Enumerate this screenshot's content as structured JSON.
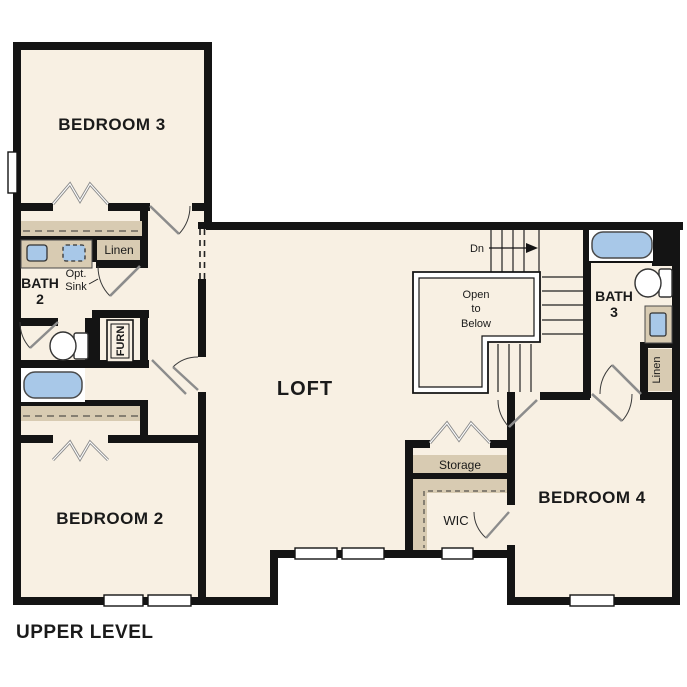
{
  "title": "UPPER LEVEL",
  "palette": {
    "wall": "#141414",
    "floor": "#f8f0e3",
    "cabinet_tan": "#d8cbb2",
    "fixture_blue": "#a8c8e8",
    "door_gray": "#8c8c8c"
  },
  "rooms": {
    "bedroom3": "BEDROOM 3",
    "bedroom2": "BEDROOM 2",
    "bedroom4": "BEDROOM 4",
    "loft": "LOFT",
    "wic": "WIC",
    "storage": "Storage",
    "bath2": {
      "line1": "BATH",
      "line2": "2"
    },
    "bath3": {
      "line1": "BATH",
      "line2": "3"
    },
    "linen_left": "Linen",
    "linen_right": "Linen",
    "furnace": "FURN",
    "opt_sink": {
      "line1": "Opt.",
      "line2": "Sink"
    }
  },
  "stairs": {
    "down_label": "Dn",
    "open_below": {
      "line1": "Open",
      "line2": "to",
      "line3": "Below"
    }
  }
}
